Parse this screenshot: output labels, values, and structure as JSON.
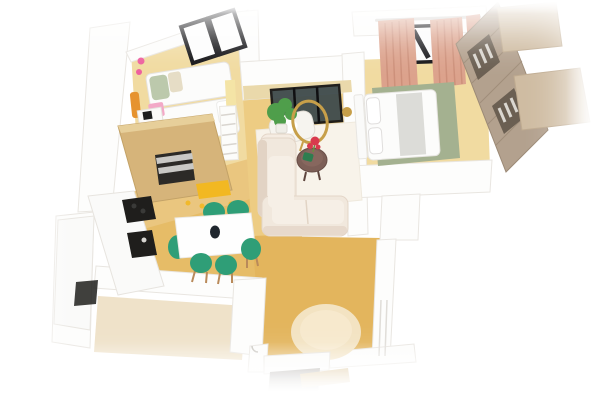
{
  "scene": {
    "kind": "3d-apartment-floor-plan-render",
    "background": "#ffffff",
    "view": "isometric-top-down"
  },
  "palette": {
    "bg": "#ffffff",
    "wood_pale": "#f1dba1",
    "wood_mid": "#edcc83",
    "wood_deep": "#e6bc67",
    "wood_hall": "#e3b55d",
    "tile_beige": "#efe2c9",
    "wall_white": "#fdfdfc",
    "wall_shade": "#e9e6e1",
    "cabinet_oak": "#d6b47a",
    "cabinet_oak_light": "#e7cf9a",
    "counter_white": "#fafaf9",
    "appliance_black": "#1f1e1c",
    "oven_dark": "#2c2a27",
    "steel_gray": "#c9c8c5",
    "chair_green": "#2f9e77",
    "chair_leg_brown": "#b98a5a",
    "table_white": "#fefefe",
    "accent_yellow": "#f2b822",
    "pale_yellow": "#f4e4a6",
    "sofa_cream": "#f1e8dd",
    "sofa_light": "#f6efe6",
    "sofa_shadow": "#e2d3c4",
    "rug_white": "#f8f3ea",
    "rug_round": "#f3e3c2",
    "rug_sage": "#a4b190",
    "bed_white": "#fcfcfb",
    "blanket_gray": "#dcdcd8",
    "pillow_green": "#bcc9ac",
    "pillow_beige": "#e6ddc6",
    "curtain_salmon": "#dca28c",
    "curtain_fold": "#c98a74",
    "wardrobe_taupe": "#b3a18e",
    "wardrobe_edge": "#9c8a76",
    "wardrobe_dark": "#6b5f52",
    "clothes_light": "#dbd7d0",
    "panel_tan": "#cfbca2",
    "window_black": "#141417",
    "glass_dark": "#3a474b",
    "lamp_gold": "#c79f49",
    "flower_red": "#d93a4d",
    "plant_green": "#4f9e4b",
    "pot_white": "#f0eee8",
    "decor_pink": "#ee5f9e",
    "dresser_pink": "#f3a9c7",
    "decor_orange": "#e6932f",
    "coffee_table_brown": "#7d5f57",
    "deco_green_dark": "#2e7d4f",
    "door_gray": "#8d8a84",
    "vase_black": "#20262e"
  },
  "rooms": [
    {
      "id": "child-bedroom",
      "items": [
        "black-frame-window",
        "single-bed-1",
        "single-bed-2",
        "pink-wall-decals",
        "orange-organizer",
        "pink-dresser",
        "desk-with-laptop",
        "ladder-shelf"
      ]
    },
    {
      "id": "kitchen",
      "items": [
        "tall-oven-cabinet",
        "built-in-oven",
        "cooktop",
        "sink",
        "lower-cabinet-run",
        "yellow-bench"
      ]
    },
    {
      "id": "dining-area",
      "items": [
        "white-dining-table",
        "green-chairs",
        "black-vase",
        "ceiling-spotlights"
      ],
      "chair_count": 6
    },
    {
      "id": "living-room",
      "items": [
        "balcony-glazed-doors",
        "sectional-sofa",
        "white-armchair",
        "arc-floor-lamp",
        "potted-plant",
        "round-coffee-table",
        "rose-plant",
        "white-area-rug",
        "brass-wall-decor"
      ]
    },
    {
      "id": "master-bedroom",
      "items": [
        "curtain-rod",
        "salmon-curtains",
        "black-frame-window",
        "double-bed",
        "sage-green-rug",
        "open-wardrobe",
        "wardrobe-side-panels"
      ]
    },
    {
      "id": "hallway",
      "items": [
        "round-beige-rug",
        "entrance-door",
        "door-swing-mark",
        "interior-door-wall"
      ]
    },
    {
      "id": "bathroom",
      "items": [
        "beige-tile-floor"
      ]
    }
  ]
}
